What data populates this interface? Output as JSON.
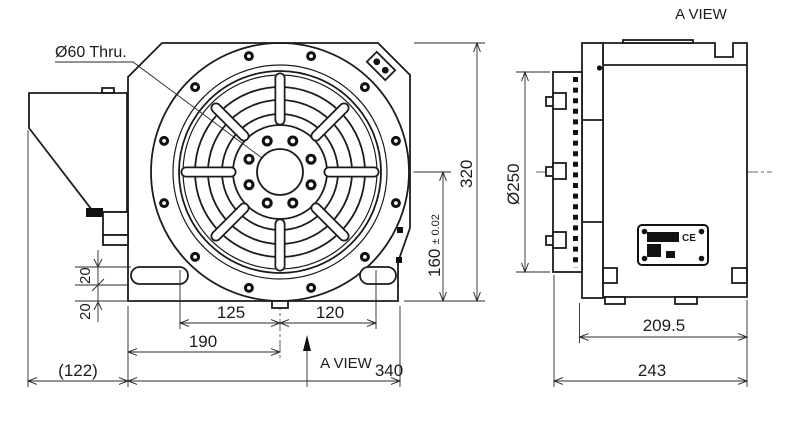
{
  "labels": {
    "bore_callout": "Ø60 Thru.",
    "a_view_top": "A VIEW",
    "a_view_front": "A VIEW",
    "ce": "CE"
  },
  "dims": {
    "front_total_height": "320",
    "front_center_height": "160",
    "front_center_height_tol": "± 0.02",
    "slot_step_upper": "20",
    "slot_step_lower": "20",
    "center_left": "125",
    "center_right": "120",
    "base_left_to_center": "190",
    "base_width": "340",
    "motor_overhang": "(122)",
    "faceplate_diameter": "Ø250",
    "body_depth": "209.5",
    "overall_depth": "243"
  }
}
